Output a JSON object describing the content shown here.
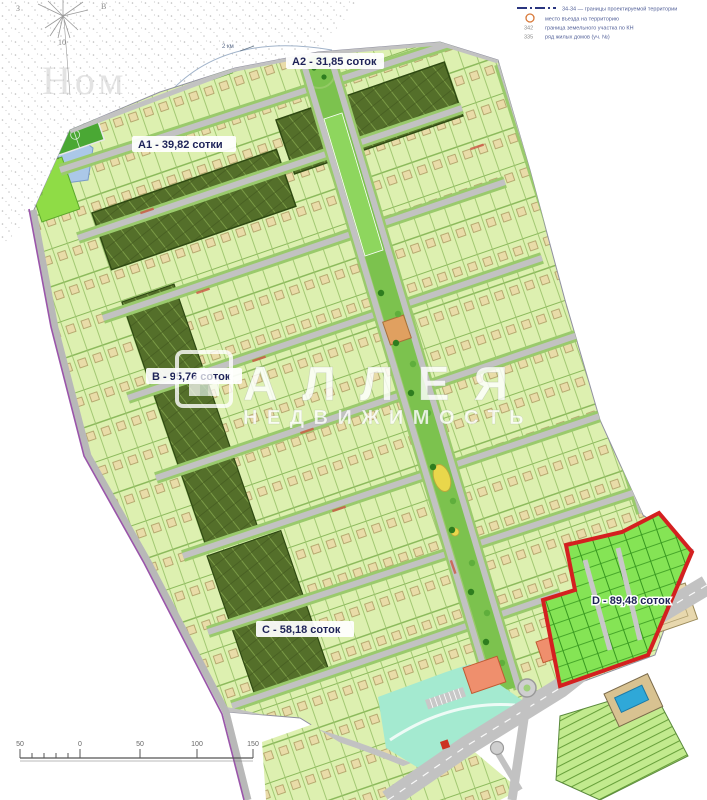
{
  "map_meta": {
    "type": "site-plan-masterplan"
  },
  "areas": [
    {
      "code": "A1",
      "label": "A1 - 39,82 сотки"
    },
    {
      "code": "A2",
      "label": "A2 - 31,85 соток"
    },
    {
      "code": "B",
      "label": "B - 95,76 соток"
    },
    {
      "code": "C",
      "label": "C - 58,18 соток"
    },
    {
      "code": "D",
      "label": "D - 89,48 соток"
    }
  ],
  "watermark": {
    "brand": "АЛЛЕЯ",
    "brand_sub": "НЕДВИЖИМОСТЬ",
    "corner": "Ном"
  },
  "compass": {
    "west": "З",
    "east": "В",
    "number": "10"
  },
  "notes": {
    "distance": "2 км",
    "pond_number": "4796",
    "plot_number": "1237"
  },
  "legend": {
    "rows": [
      {
        "kind": "line",
        "text": "34-34 — границы проектируемой территории"
      },
      {
        "kind": "circle",
        "text": "место въезда на территорию"
      },
      {
        "kind": "number",
        "number": "342",
        "text": "граница земельного участка по КН"
      },
      {
        "kind": "number",
        "number": "335",
        "text": "ряд жилых домов (уч. №)"
      }
    ]
  },
  "scalebar": {
    "labels": [
      "50",
      "0",
      "50",
      "100",
      "150"
    ]
  },
  "colors": {
    "zone_d_border": "#d42020",
    "plot_fill": "#ddf0b0",
    "dark_zone": "#546f2a",
    "bright_plot": "#85e455",
    "road": "#c2c2c2",
    "water": "#abc8e8",
    "label_text": "#1e2358"
  }
}
